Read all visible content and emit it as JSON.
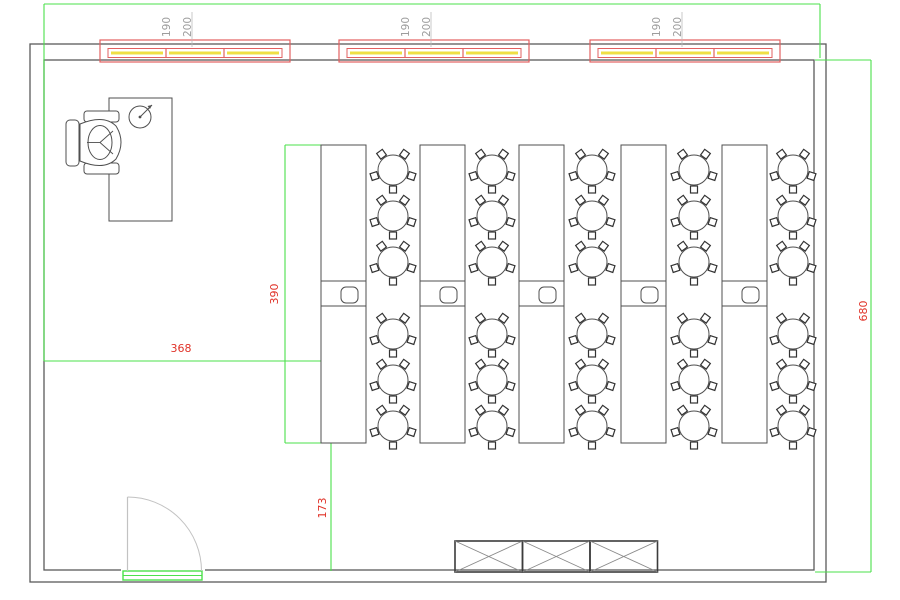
{
  "drawing": {
    "type": "floor-plan",
    "dimensions": {
      "room_height_label": "680",
      "bench_length_label": "390",
      "left_offset_label": "368",
      "bottom_offset_label": "173"
    },
    "windows": {
      "count": 3,
      "panes_per_window": 3,
      "width_label": "190",
      "height_label": "200"
    },
    "benches": {
      "count": 5,
      "sinks_per_bench": 1
    },
    "tables": {
      "columns": 5,
      "per_column": 6,
      "stools_per_table": 5
    },
    "cabinets": {
      "count": 3
    },
    "doors": {
      "count": 1
    },
    "teacher_station": {
      "desks": 1,
      "chairs": 1
    },
    "colors": {
      "wall_gray": "#5a5a5a",
      "furniture_gray": "#4f4f4f",
      "light_gray": "#c2c2c2",
      "dimension_green": "#4be14b",
      "dimension_red_text": "#e03228",
      "window_red": "#e26060",
      "window_yellow": "#efdf45",
      "label_gray": "#9d9d9d"
    }
  }
}
